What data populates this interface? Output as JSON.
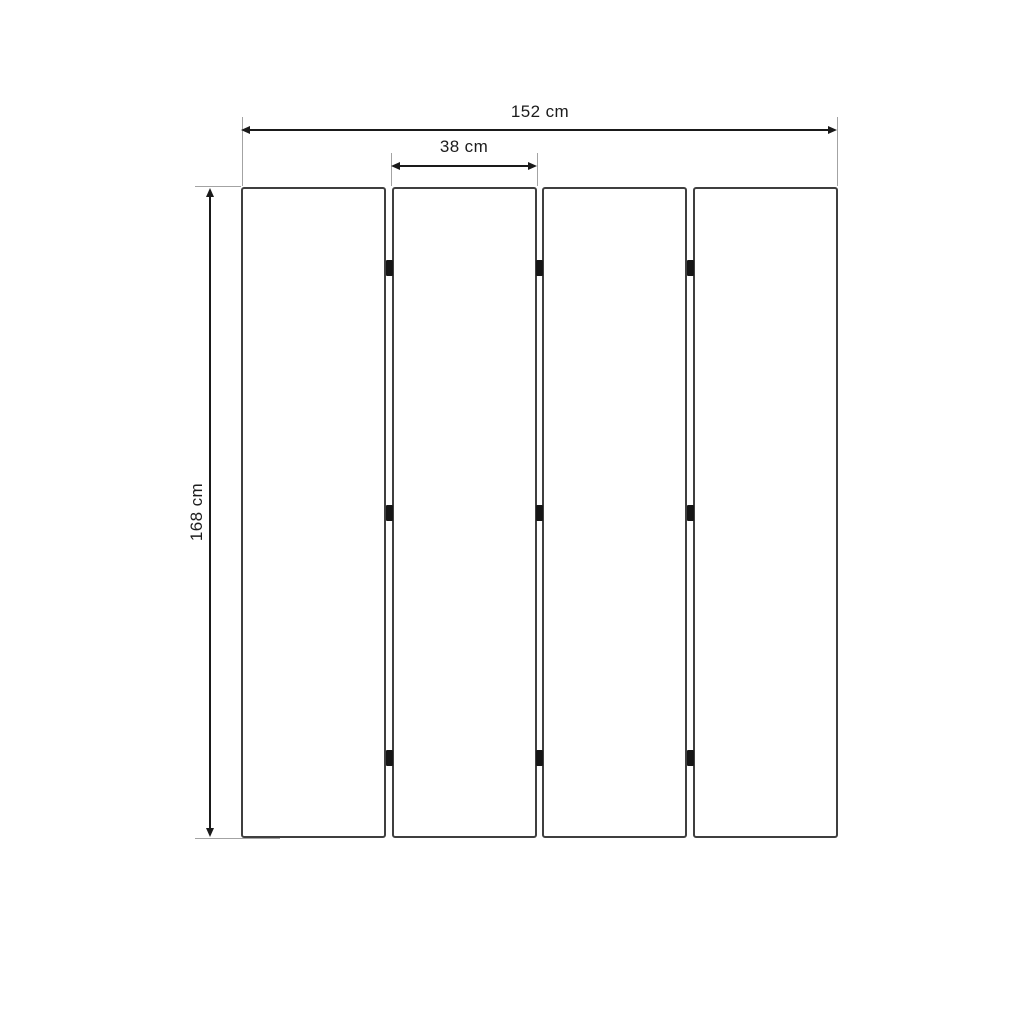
{
  "diagram": {
    "type": "dimension-drawing",
    "subject": "four-panel folding room divider",
    "labels": {
      "total_width": "152 cm",
      "panel_width": "38 cm",
      "height": "168 cm"
    },
    "panels": {
      "count": 4
    },
    "hinge_marks": {
      "gap_columns": 3,
      "per_gap": 3
    },
    "colors": {
      "background": "#ffffff",
      "panel_border": "#3f3f3f",
      "dimension_line": "#1a1a1a",
      "extension_line": "#a3a3a3",
      "hinge": "#161616",
      "label_text": "#1c1c1c"
    }
  }
}
